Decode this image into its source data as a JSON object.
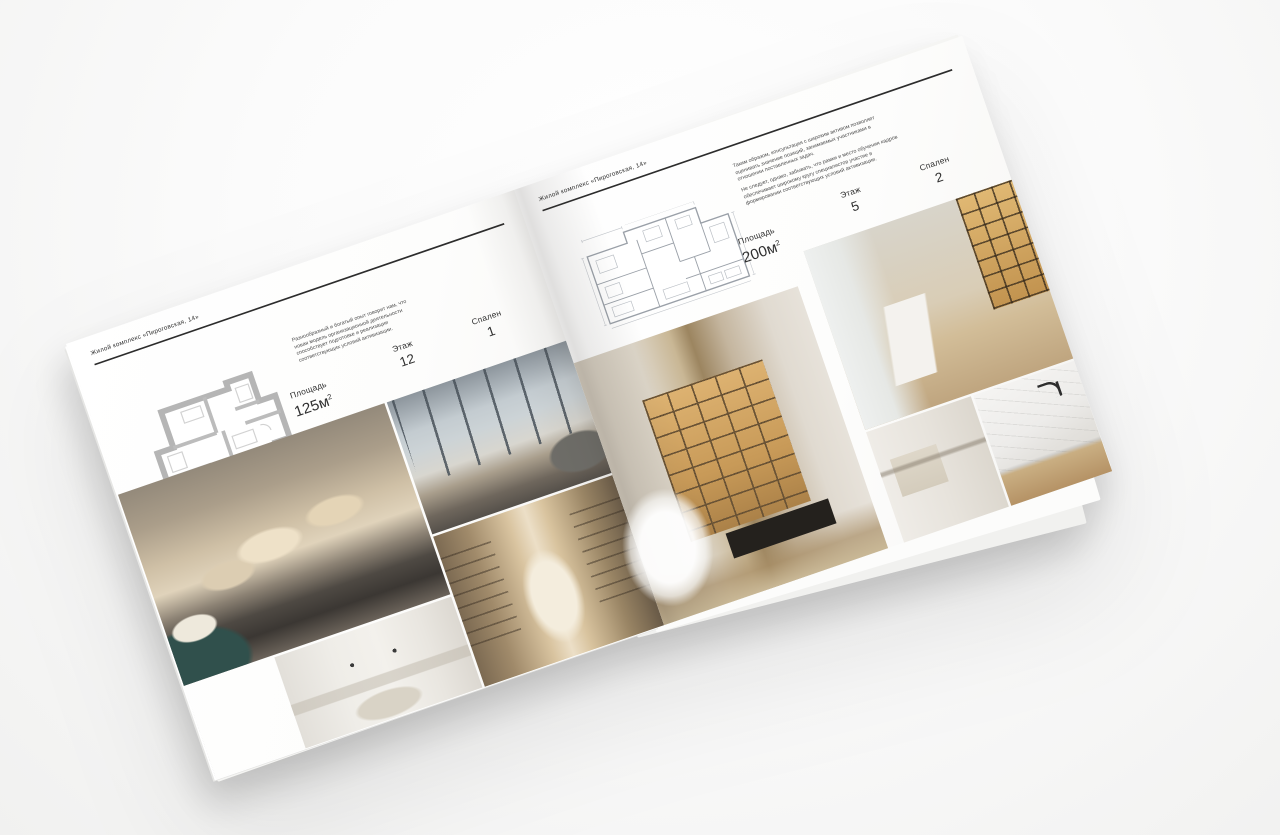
{
  "background_color": "#fafafa",
  "accent_rule_color": "#2c2c2c",
  "brochure": {
    "left_page": {
      "header": "Жилой комплекс «Пироговская, 14»",
      "description": "Разнообразный и богатый опыт говорит нам, что новая модель организационной деятельности способствует подготовке и реализации соответствующих условий активизации.",
      "stats": {
        "area_label": "Площадь",
        "area_value": "125м",
        "area_sup": "2",
        "floor_label": "Этаж",
        "floor_value": "12",
        "bedrooms_label": "Спален",
        "bedrooms_value": "1"
      },
      "floor_plan": "floor-plan-125m2",
      "photos": [
        "bedroom-with-pillows",
        "living-room-panoramic-windows",
        "white-bedroom",
        "library-hallway-arch"
      ]
    },
    "right_page": {
      "header": "Жилой комплекс «Пироговская, 14»",
      "description_1": "Таким образом, консультация с широким активом позволяет оценивать значение позиций, занимаемых участниками в отношении поставленных задач.",
      "description_2": "Не следует, однако, забывать, что рамки и место обучения кадров обеспечивает широкому кругу специалистов участие в формировании соответствующих условий активизации.",
      "stats": {
        "area_label": "Площадь",
        "area_value": "200м",
        "area_sup": "2",
        "floor_label": "Этаж",
        "floor_value": "5",
        "bedrooms_label": "Спален",
        "bedrooms_value": "2"
      },
      "floor_plan": "floor-plan-200m2",
      "photos": [
        "kitchen-illuminated-cabinets",
        "study-room-desk",
        "bathroom-towel-rail",
        "marble-counter-faucet"
      ]
    }
  }
}
